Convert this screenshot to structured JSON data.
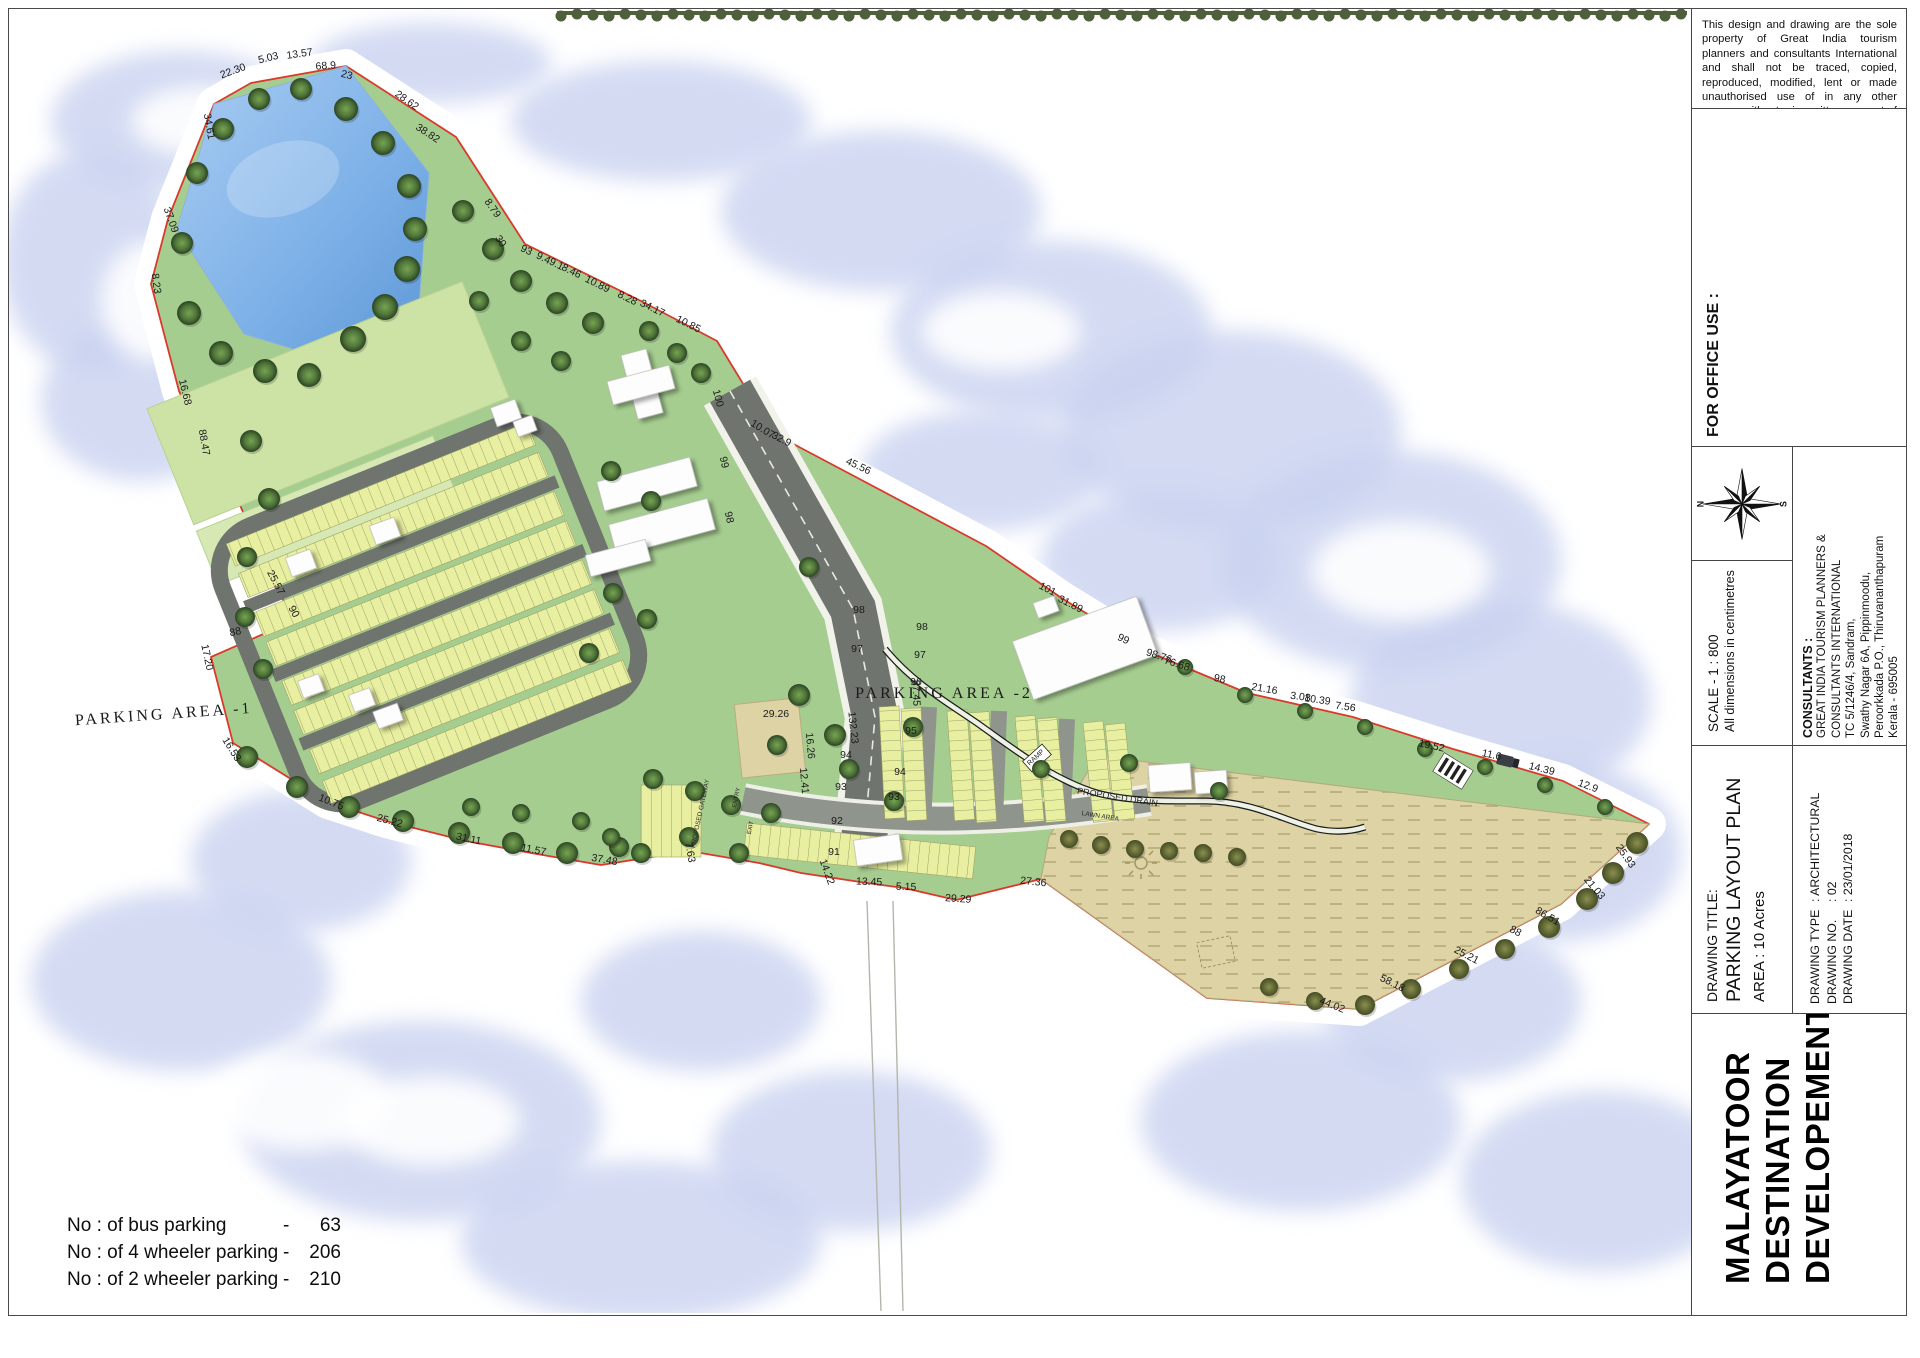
{
  "title_block": {
    "disclaimer": "This design and drawing are the sole property of Great India tourism planners and consultants International and shall not be traced, copied, reproduced, modified, lent or made unauthorised use of in any other manner without prior written consent of the Architect",
    "office_use_label": "FOR OFFICE USE :",
    "compass": {
      "north_label": "N",
      "south_label": "S"
    },
    "scale": {
      "line1": "SCALE - 1 : 800",
      "line2": "All dimensions in centimetres"
    },
    "consultants": {
      "heading": "CONSULTANTS :",
      "lines": [
        "GREAT INDIA TOURISM PLANNERS &",
        "CONSULTANTS INTERNATIONAL",
        "TC 5/1246/4, Sandram,",
        "Swathy Nagar 6A, Pippinmoodu,",
        "Peroorkkada P.O., Thiruvananthapuram",
        "Kerala - 695005"
      ]
    },
    "drawing_title": {
      "label": "DRAWING TITLE:",
      "title": "PARKING LAYOUT PLAN",
      "area": "AREA : 10 Acres"
    },
    "drawing_meta": [
      {
        "label": "DRAWING TYPE",
        "value": ": ARCHITECTURAL"
      },
      {
        "label": "DRAWING NO.",
        "value": ": 02"
      },
      {
        "label": "DRAWING DATE",
        "value": ": 23/01/2018"
      }
    ],
    "project": {
      "line1": "MALAYATOOR",
      "line2": "DESTINATION",
      "line3": "DEVELOPEMENT"
    }
  },
  "stats": {
    "rows": [
      {
        "label": "No : of bus parking",
        "dash": "-",
        "value": "63"
      },
      {
        "label": "No : of 4 wheeler parking",
        "dash": "-",
        "value": "206"
      },
      {
        "label": "No : of 2 wheeler parking",
        "dash": "-",
        "value": "210"
      }
    ]
  },
  "map": {
    "area_labels": [
      {
        "text": "PARKING AREA -1",
        "x": 163,
        "y": 718,
        "rot": -4
      },
      {
        "text": "PARKING AREA -2",
        "x": 943,
        "y": 697,
        "rot": 0
      }
    ],
    "small_labels": [
      {
        "text": "PROPOSED GATEWAY",
        "x": 701,
        "y": 813,
        "rot": -78,
        "size": 6.5
      },
      {
        "text": "ENTRY",
        "x": 737,
        "y": 797,
        "rot": -78,
        "size": 6
      },
      {
        "text": "EXIT",
        "x": 751,
        "y": 827,
        "rot": -78,
        "size": 6
      },
      {
        "text": "RAMP",
        "x": 1036,
        "y": 758,
        "rot": -42,
        "size": 7
      },
      {
        "text": "PROPOSED DRAIN",
        "x": 1116,
        "y": 799,
        "rot": 9,
        "size": 9
      },
      {
        "text": "LAWN AREA",
        "x": 1099,
        "y": 817,
        "rot": 9,
        "size": 6.5
      }
    ],
    "road_markers": [
      [
        "100",
        714,
        398,
        75
      ],
      [
        "99",
        720,
        462,
        78
      ],
      [
        "98",
        725,
        517,
        78
      ],
      [
        "98",
        858,
        612,
        0
      ],
      [
        "98",
        921,
        629,
        0
      ],
      [
        "97",
        856,
        651,
        0
      ],
      [
        "97",
        919,
        657,
        0
      ],
      [
        "96",
        915,
        684,
        0
      ],
      [
        "95",
        910,
        733,
        0
      ],
      [
        "94",
        845,
        757,
        0
      ],
      [
        "94",
        899,
        774,
        0
      ],
      [
        "93",
        840,
        789,
        0
      ],
      [
        "93",
        893,
        799,
        0
      ],
      [
        "92",
        836,
        823,
        0
      ],
      [
        "91",
        833,
        854,
        0
      ],
      [
        "87.45",
        912,
        692,
        88
      ],
      [
        "132.23",
        849,
        727,
        84
      ]
    ],
    "boundary_dimensions": [
      [
        "22.30",
        233,
        73,
        -20
      ],
      [
        "5.03",
        268,
        60,
        -14
      ],
      [
        "13.57",
        299,
        56,
        -8
      ],
      [
        "68.9",
        325,
        68,
        -4
      ],
      [
        "23",
        345,
        77,
        14
      ],
      [
        "34.61",
        205,
        126,
        80
      ],
      [
        "28.62",
        404,
        102,
        35
      ],
      [
        "38.82",
        425,
        135,
        33
      ],
      [
        "8.79",
        489,
        209,
        55
      ],
      [
        "30",
        497,
        242,
        55
      ],
      [
        "93",
        524,
        252,
        26
      ],
      [
        "9.4",
        541,
        260,
        26
      ],
      [
        "9.1",
        554,
        266,
        26
      ],
      [
        "8.46",
        569,
        273,
        26
      ],
      [
        "10.89",
        595,
        286,
        26
      ],
      [
        "8.28",
        625,
        300,
        26
      ],
      [
        "34.17",
        650,
        310,
        26
      ],
      [
        "10.85",
        686,
        326,
        26
      ],
      [
        "10.07",
        760,
        431,
        32
      ],
      [
        "32.9",
        779,
        441,
        28
      ],
      [
        "45.56",
        856,
        468,
        25
      ],
      [
        "101",
        1045,
        591,
        27
      ],
      [
        "31.89",
        1068,
        606,
        27
      ],
      [
        "99",
        1121,
        641,
        25
      ],
      [
        "98.76",
        1157,
        658,
        18
      ],
      [
        "76.68",
        1175,
        666,
        18
      ],
      [
        "98",
        1218,
        681,
        12
      ],
      [
        "21.16",
        1263,
        691,
        10
      ],
      [
        "3.08",
        1299,
        699,
        8
      ],
      [
        "10.39",
        1316,
        702,
        8
      ],
      [
        "7.56",
        1344,
        709,
        8
      ],
      [
        "19.52",
        1430,
        748,
        12
      ],
      [
        "11.6",
        1490,
        757,
        12
      ],
      [
        "14.39",
        1540,
        771,
        14
      ],
      [
        "12.9",
        1586,
        788,
        20
      ],
      [
        "25.93",
        1622,
        857,
        55
      ],
      [
        "21.03",
        1591,
        889,
        50
      ],
      [
        "86.51",
        1545,
        918,
        30
      ],
      [
        "88",
        1513,
        933,
        28
      ],
      [
        "25.21",
        1464,
        957,
        28
      ],
      [
        "58.18",
        1390,
        985,
        26
      ],
      [
        "44.02",
        1330,
        1007,
        22
      ],
      [
        "27.36",
        1032,
        884,
        6
      ],
      [
        "29.29",
        957,
        901,
        4
      ],
      [
        "5.15",
        905,
        889,
        2
      ],
      [
        "13.45",
        868,
        884,
        2
      ],
      [
        "14.22",
        823,
        872,
        70
      ],
      [
        "7.63",
        686,
        852,
        80
      ],
      [
        "37.48",
        603,
        862,
        10
      ],
      [
        "11.57",
        532,
        852,
        11
      ],
      [
        "31.11",
        467,
        841,
        12
      ],
      [
        "25.22",
        388,
        823,
        15
      ],
      [
        "10.75",
        329,
        804,
        22
      ],
      [
        "16.53",
        228,
        750,
        58
      ],
      [
        "17.20",
        203,
        657,
        78
      ],
      [
        "88",
        235,
        634,
        -12
      ],
      [
        "90",
        290,
        612,
        62
      ],
      [
        "25.57",
        272,
        583,
        62
      ],
      [
        "88.47",
        200,
        442,
        80
      ],
      [
        "16.68",
        181,
        392,
        76
      ],
      [
        "8.23",
        152,
        283,
        82
      ],
      [
        "37.09",
        167,
        220,
        70
      ],
      [
        "29.26",
        775,
        716,
        0
      ],
      [
        "16.26",
        806,
        745,
        85
      ],
      [
        "12.41",
        800,
        780,
        85
      ]
    ],
    "colors": {
      "boundary_red": "#d93a2b",
      "grass": "#a6cd90",
      "grass_light": "#cde3a6",
      "parking_yellow": "#e9efa0",
      "road_dark": "#6f746e",
      "road_mid": "#8f948d",
      "pond_blue": "#7fb2e8",
      "cloud": "#c9d2f0",
      "sand": "#ddd3a4",
      "tree_green": "#3f5c33",
      "tree_olive": "#5f6a39"
    }
  }
}
